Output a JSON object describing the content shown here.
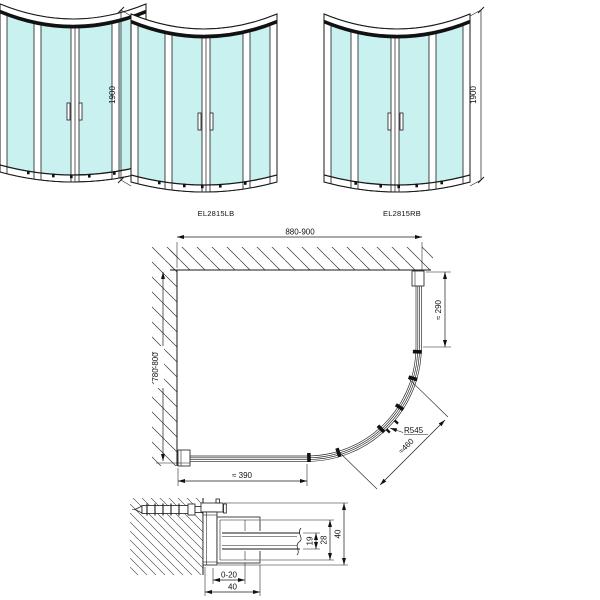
{
  "views": {
    "elevation_left": {
      "label": "EL2815LB",
      "height": "1900"
    },
    "elevation_right": {
      "label": "EL2815RB",
      "height": "1900"
    },
    "plan": {
      "width": "880-900",
      "depth": "780-800",
      "side": "≈ 290",
      "front": "≈ 390",
      "radius": "R545",
      "entry": "≈460"
    },
    "detail": {
      "adjust": "0-20",
      "profile_width": "40",
      "glass_gap": "19",
      "inner_profile": "28",
      "profile_height": "40"
    }
  },
  "colors": {
    "glass": "#c9f1ef",
    "line": "#1a1a1a"
  }
}
